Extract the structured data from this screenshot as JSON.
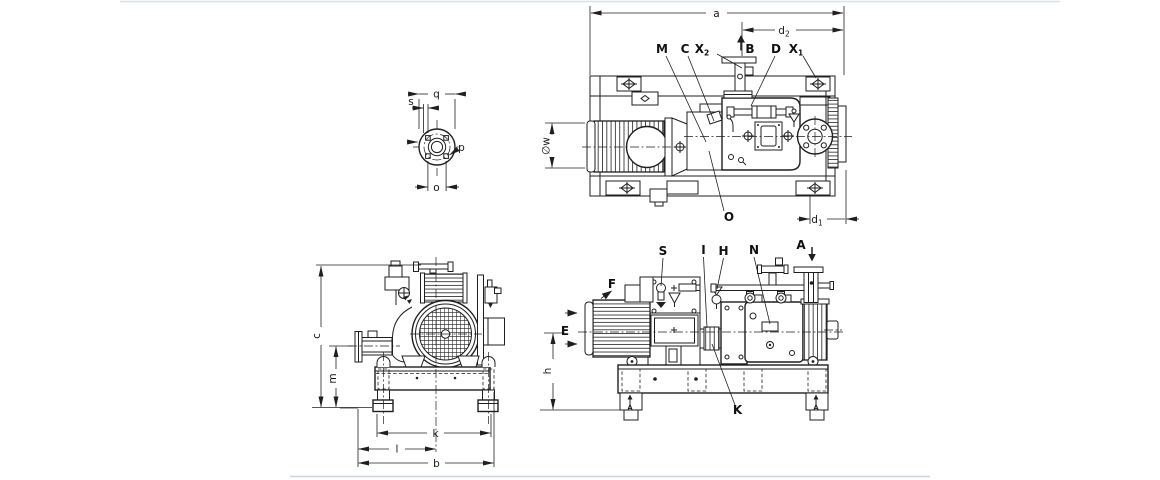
{
  "document": {
    "background": "#ffffff",
    "line_color": "#1f1f1f"
  },
  "views": {
    "flange_detail": {
      "name": "flange-detail-view"
    },
    "top": {
      "name": "top-view"
    },
    "front": {
      "name": "front-view"
    },
    "side": {
      "name": "side-view"
    }
  },
  "labels": [
    {
      "view": "flange_detail",
      "name": "dim-q",
      "text": "q",
      "x": 436.5,
      "y": 97.5,
      "cls": "dim"
    },
    {
      "view": "flange_detail",
      "name": "dim-s",
      "text": "s",
      "x": 411,
      "y": 105,
      "cls": "dim"
    },
    {
      "view": "flange_detail",
      "name": "dim-p",
      "text": "p",
      "x": 461.5,
      "y": 151,
      "cls": "dim"
    },
    {
      "view": "flange_detail",
      "name": "dim-o",
      "text": "o",
      "x": 436.5,
      "y": 191,
      "cls": "dim"
    },
    {
      "view": "top",
      "name": "dim-a",
      "text": "a",
      "x": 716.5,
      "y": 17,
      "cls": "dim"
    },
    {
      "view": "top",
      "name": "dim-d2",
      "text": "d",
      "sub": "2",
      "x": 784,
      "y": 34,
      "cls": "dim"
    },
    {
      "view": "top",
      "name": "port-m",
      "text": "M",
      "x": 662,
      "y": 53,
      "cls": "port"
    },
    {
      "view": "top",
      "name": "port-c",
      "text": "C",
      "x": 685,
      "y": 53,
      "cls": "port"
    },
    {
      "view": "top",
      "name": "port-x2",
      "text": "X",
      "sub": "2",
      "x": 702,
      "y": 53,
      "cls": "port"
    },
    {
      "view": "top",
      "name": "flow-b",
      "text": "B",
      "x": 750,
      "y": 53,
      "cls": "port"
    },
    {
      "view": "top",
      "name": "port-d",
      "text": "D",
      "x": 776,
      "y": 53,
      "cls": "port"
    },
    {
      "view": "top",
      "name": "port-x1",
      "text": "X",
      "sub": "1",
      "x": 796,
      "y": 53,
      "cls": "port"
    },
    {
      "view": "top",
      "name": "port-o",
      "text": "O",
      "x": 729,
      "y": 221,
      "cls": "port"
    },
    {
      "view": "top",
      "name": "dim-d1",
      "text": "d",
      "sub": "1",
      "x": 817,
      "y": 223,
      "cls": "dim"
    },
    {
      "view": "top",
      "name": "dim-w",
      "text": "∅w",
      "x": 549.5,
      "y": 146,
      "cls": "dim",
      "rot": -90
    },
    {
      "view": "front",
      "name": "dim-c",
      "text": "c",
      "x": 320,
      "y": 336,
      "cls": "dim",
      "rot": -90
    },
    {
      "view": "front",
      "name": "dim-m",
      "text": "m",
      "x": 336,
      "y": 378.5,
      "cls": "dim",
      "rot": -90
    },
    {
      "view": "front",
      "name": "dim-k",
      "text": "k",
      "x": 435.5,
      "y": 437,
      "cls": "dim"
    },
    {
      "view": "front",
      "name": "dim-l",
      "text": "l",
      "x": 397,
      "y": 452.5,
      "cls": "dim"
    },
    {
      "view": "front",
      "name": "dim-b",
      "text": "b",
      "x": 436.5,
      "y": 467,
      "cls": "dim"
    },
    {
      "view": "side",
      "name": "port-s",
      "text": "S",
      "x": 663,
      "y": 255,
      "cls": "port"
    },
    {
      "view": "side",
      "name": "port-i",
      "text": "I",
      "x": 703.5,
      "y": 254,
      "cls": "port"
    },
    {
      "view": "side",
      "name": "port-h",
      "text": "H",
      "x": 723.5,
      "y": 255,
      "cls": "port"
    },
    {
      "view": "side",
      "name": "port-n",
      "text": "N",
      "x": 754,
      "y": 254,
      "cls": "port"
    },
    {
      "view": "side",
      "name": "port-a",
      "text": "A",
      "x": 801,
      "y": 249,
      "cls": "port"
    },
    {
      "view": "side",
      "name": "view-f",
      "text": "F",
      "x": 612,
      "y": 288,
      "cls": "port"
    },
    {
      "view": "side",
      "name": "port-e",
      "text": "E",
      "x": 565,
      "y": 335,
      "cls": "port"
    },
    {
      "view": "side",
      "name": "port-k",
      "text": "K",
      "x": 737.5,
      "y": 414,
      "cls": "port"
    },
    {
      "view": "side",
      "name": "dim-h",
      "text": "h",
      "x": 551,
      "y": 371,
      "cls": "dim",
      "rot": -90
    },
    {
      "view": "side",
      "name": "section-a-left",
      "text": "A",
      "x": 630,
      "y": 409.5,
      "cls": "marker"
    },
    {
      "view": "side",
      "name": "section-a-right",
      "text": "A",
      "x": 816,
      "y": 409.5,
      "cls": "marker"
    }
  ]
}
